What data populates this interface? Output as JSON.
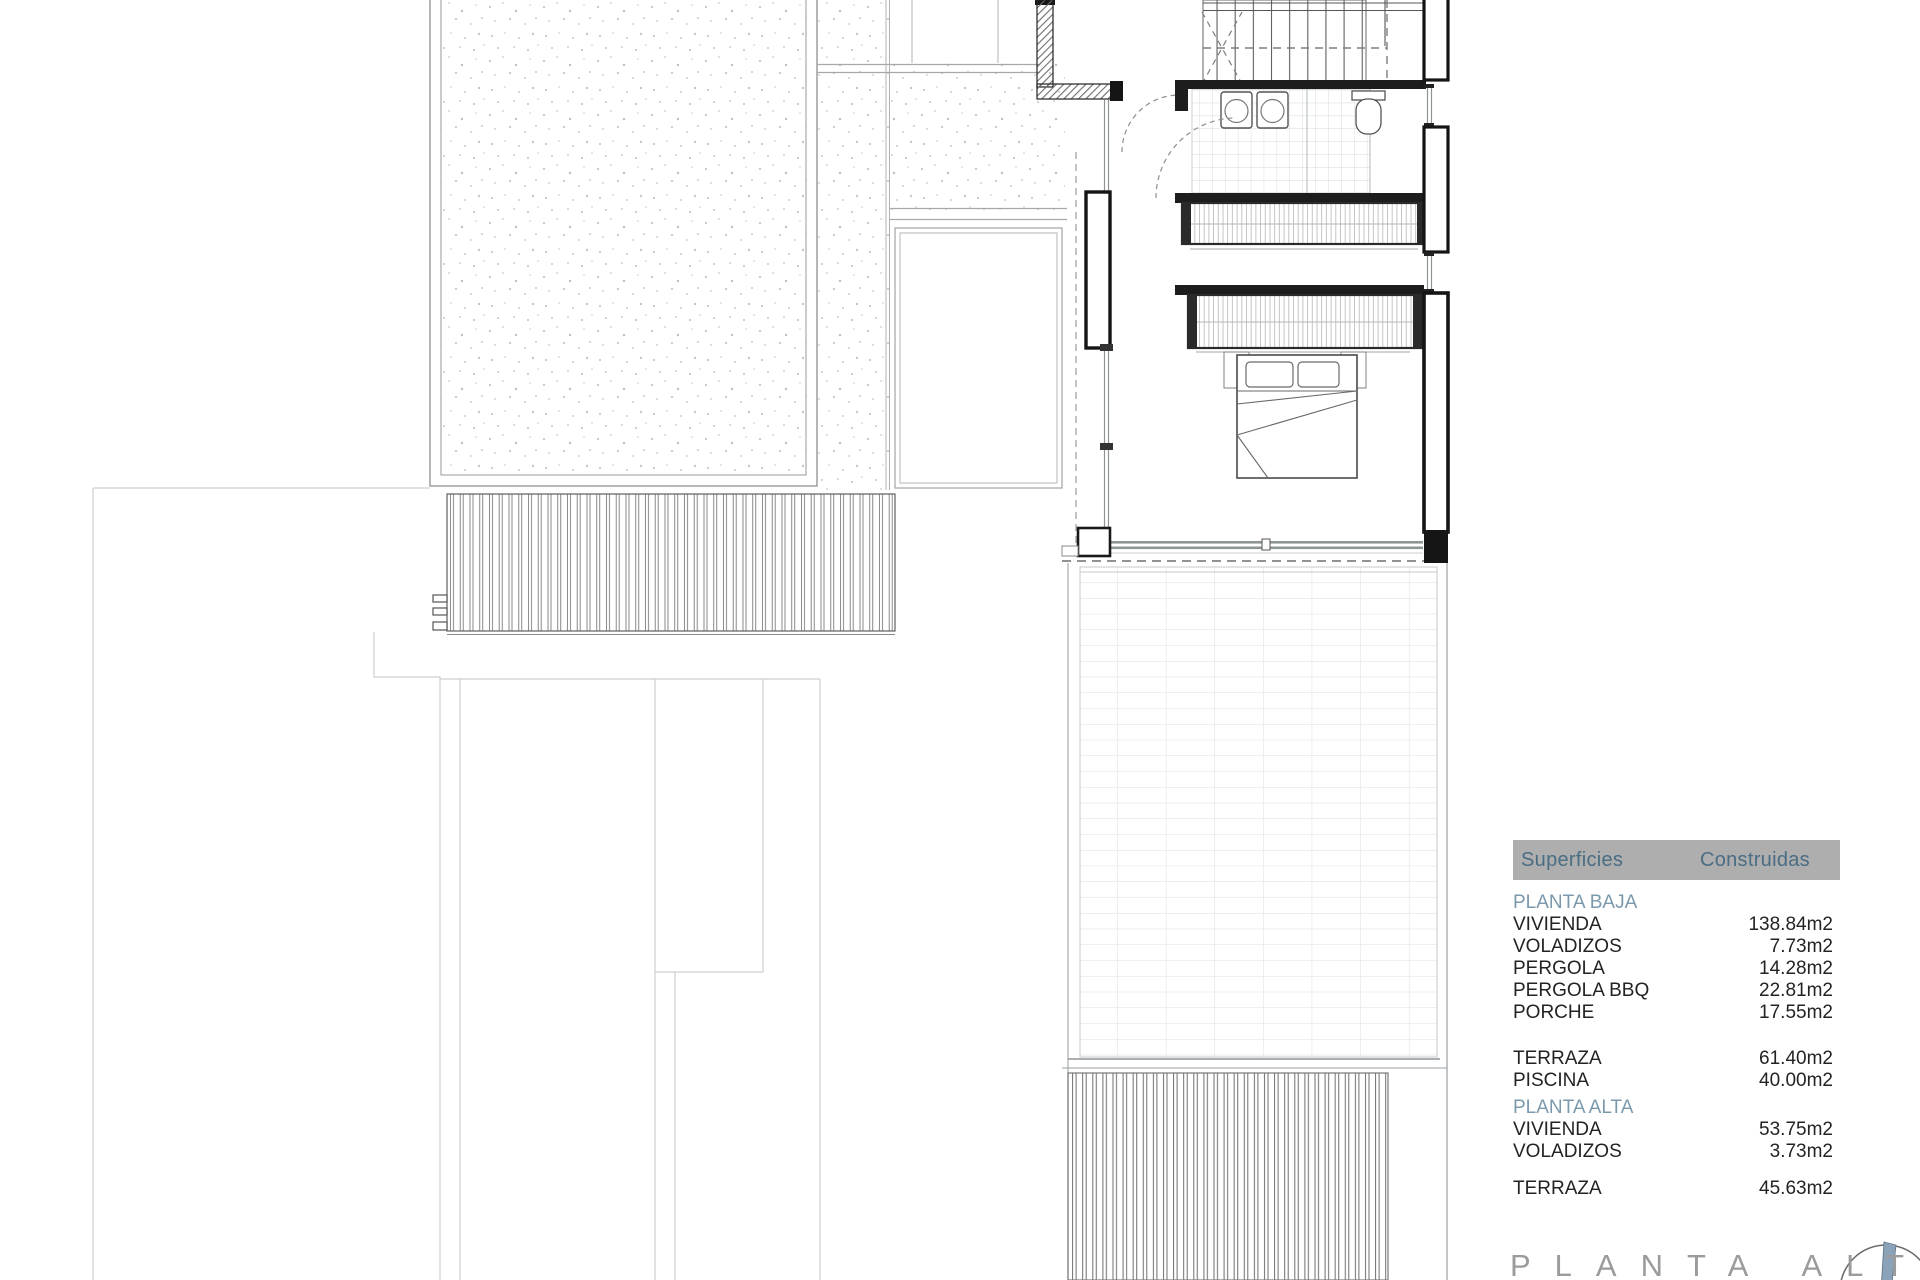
{
  "plan": {
    "title": "PLANTA ALTA"
  },
  "areas_table": {
    "header": {
      "col1": "Superficies",
      "col2": "Construidas"
    },
    "sections": [
      {
        "title": "PLANTA BAJA",
        "rows": [
          {
            "label": "VIVIENDA",
            "value": "138.84m2"
          },
          {
            "label": "VOLADIZOS",
            "value": "7.73m2"
          },
          {
            "label": "PERGOLA",
            "value": "14.28m2"
          },
          {
            "label": "PERGOLA BBQ",
            "value": "22.81m2"
          },
          {
            "label": "PORCHE",
            "value": "17.55m2"
          }
        ]
      },
      {
        "title": "",
        "rows": [
          {
            "label": "TERRAZA",
            "value": "61.40m2"
          },
          {
            "label": "PISCINA",
            "value": "40.00m2"
          }
        ]
      },
      {
        "title": "PLANTA ALTA",
        "rows": [
          {
            "label": "VIVIENDA",
            "value": "53.75m2"
          },
          {
            "label": "VOLADIZOS",
            "value": "3.73m2"
          }
        ]
      },
      {
        "title": "",
        "rows": [
          {
            "label": "TERRAZA",
            "value": "45.63m2"
          }
        ]
      }
    ]
  },
  "colors": {
    "header_bar": "#aeaeae",
    "header_text": "#4a6d84",
    "section_title": "#7b99ad",
    "body_text": "#232323",
    "wall": "#1d1d1d",
    "glass": "#8f9496",
    "compass_needle": "#8ba3b8"
  }
}
